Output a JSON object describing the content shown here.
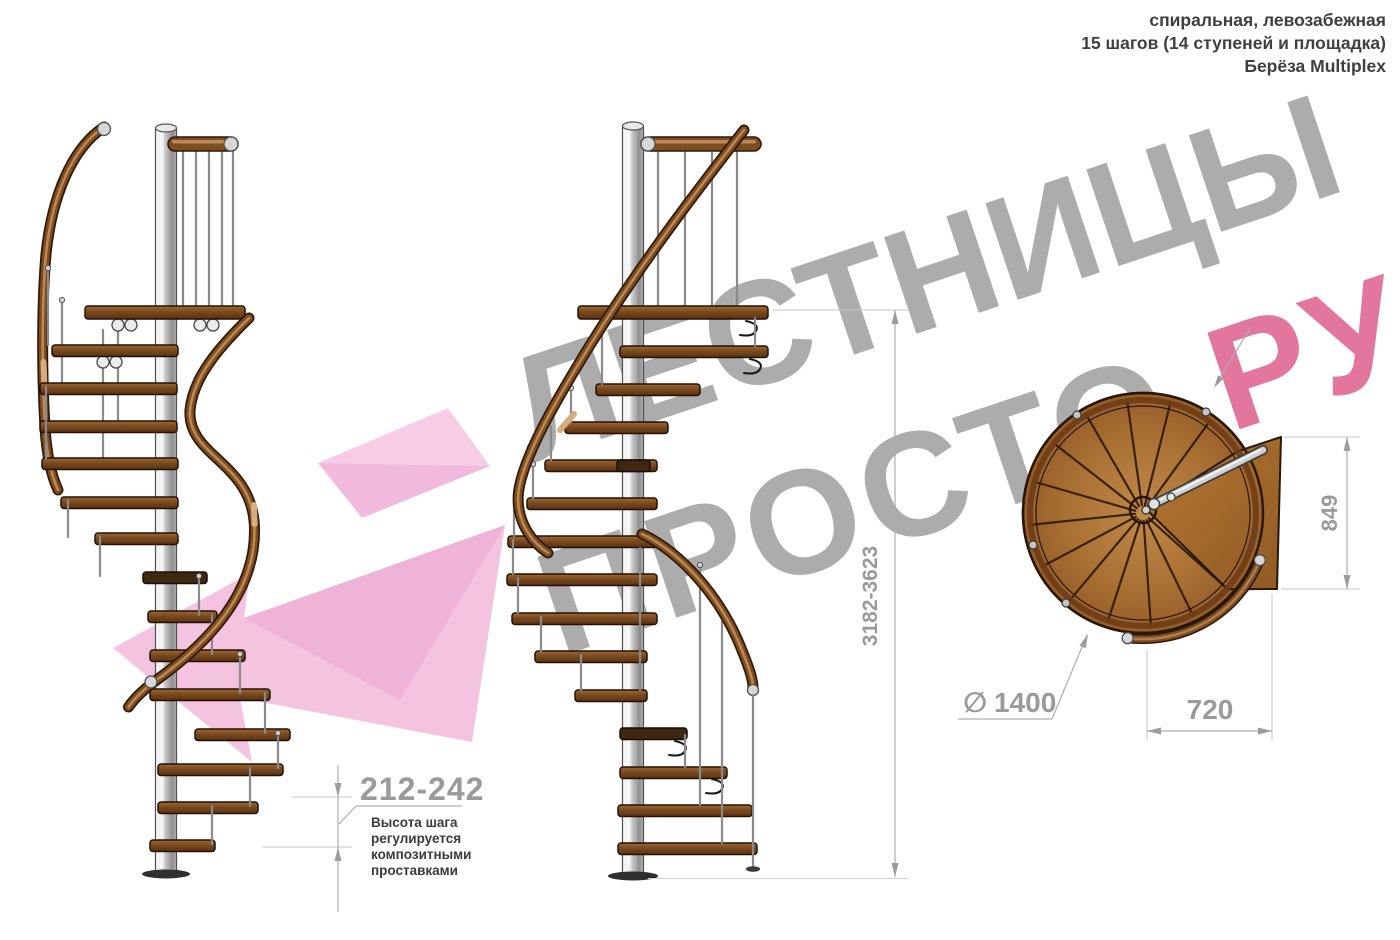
{
  "header": {
    "line1": "спиральная, левозабежная",
    "line2": "15 шагов (14 ступеней и площадка)",
    "line3": "Берёза Multiplex"
  },
  "watermark": {
    "word1": "ЛЕСТНИЦЫ",
    "word2": "ПРОСТО",
    "word2_suffix": ".РУ",
    "gray_color": "#a6a6a6",
    "pink_color": "#e06b96",
    "arrow_color": "#f2b9da"
  },
  "dimensions": {
    "step_height": "212-242",
    "step_height_note": [
      "Высота шага",
      "регулируется",
      "композитными",
      "проставками"
    ],
    "total_height": "3182-3623",
    "plan_depth": "849",
    "plan_width": "720",
    "diameter_symbol": "∅",
    "diameter": "1400"
  },
  "colors": {
    "wood": "#7e4c22",
    "metal": "#c9c9c9",
    "dimension_text": "#9a9a9a"
  }
}
